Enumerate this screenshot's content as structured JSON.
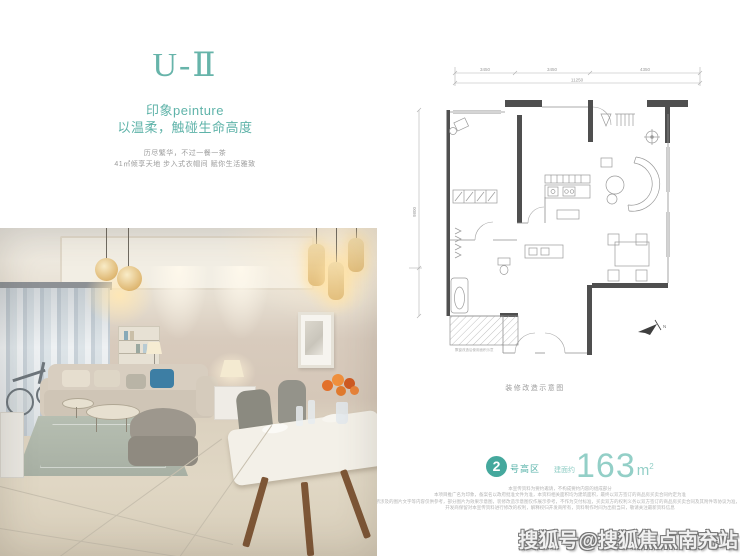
{
  "page": {
    "background": "#ffffff",
    "accent_teal": "#5fb3a9",
    "accent_teal_dark": "#45a89d",
    "accent_teal_light": "#93cfc7"
  },
  "hero": {
    "title": "U-Ⅱ",
    "subtitle_line1": "印象peinture",
    "subtitle_line2": "以温柔，触碰生命高度",
    "tagline_line1": "历尽繁华，不过一餐一茶",
    "tagline_line2": "41㎡倾享天地 步入式衣帽间 赋你生活雅致"
  },
  "floor_plan": {
    "caption": "装修改造示意图",
    "balcony_note": "飘窗改造后使用面积示意",
    "north_label": "N",
    "dim_top_1": "3450",
    "dim_top_2": "3450",
    "dim_top_3": "4350",
    "dim_top_total": "11250",
    "dim_left_total": "9800",
    "wall_color": "#4f4f4f",
    "line_color": "#9a9a9a"
  },
  "unit_info": {
    "badge_number": "2",
    "badge_suffix": "号高区",
    "area_prefix": "建面约",
    "area_value": "163",
    "area_unit_m": "m",
    "area_unit_sup": "2"
  },
  "disclaimer": {
    "lines": [
      "本宣传资料为要约邀请，不构成要约内容的组成部分",
      "本项目推广名为印象，备案名以政府批准文件为准，本资料相关面积均为建筑面积，最终以双方签订的商品房买卖合同约定为准",
      "本资料所涉及的图片文字等内容仅供参考，部分图片为效果示意图，装修改造示意图仅作展示参考，不作为交付标准，买卖双方的权利义务以双方签订的商品房买卖合同及其附件等协议为准，敬请知悉",
      "开发商保留对本宣传资料进行修改的权利，解释权归开发商所有，资料制作时间为出街当日，敬请关注最新资料信息"
    ]
  },
  "watermark": {
    "text": "搜狐号@搜狐焦点南充站"
  }
}
